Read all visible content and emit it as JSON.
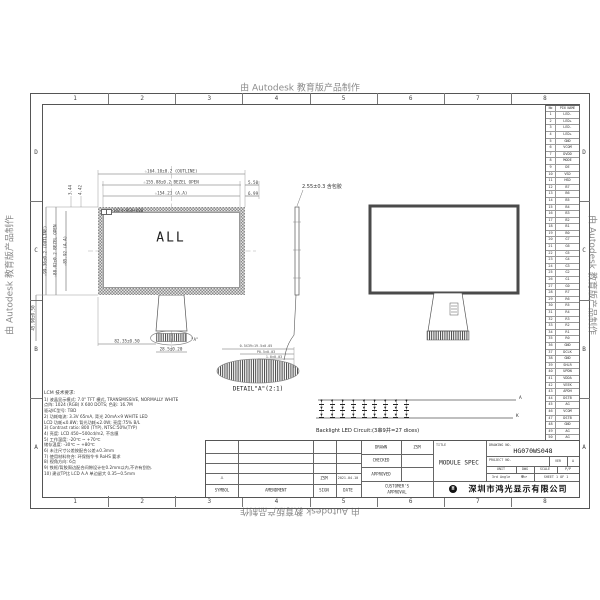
{
  "watermark": "由 Autodesk 教育版产品制作",
  "frame": {
    "columns": [
      "1",
      "2",
      "3",
      "4",
      "5",
      "6",
      "7",
      "8"
    ],
    "rows": [
      "D",
      "C",
      "B",
      "A"
    ]
  },
  "front_view": {
    "center_label": "ALL",
    "resolution_label": "1024×RGB×600",
    "dim_outline_w": "☆164.10±0.2 (OUTLINE)",
    "dim_bezel_w": "☆155.88±0.2 BEZEL OPEN",
    "dim_aa_w": "☆154.21 (A.A)",
    "dim_right_bezel": "5.50",
    "dim_right_aa": "6.99",
    "dim_outline_h": "☆99.36±0.2 (OUTLINE)",
    "dim_bezel_h": "☆88.02±0.2 BEZEL OPEN",
    "dim_aa_h": "☆85.92 (A.A)",
    "dim_fpc_drop": "45.90±0.50",
    "dim_offset_1": "3.44",
    "dim_offset_2": "4.42",
    "dim_fpc_x": "82.35±0.50",
    "dim_fpc_w": "28.5±0.20",
    "detail_ref": "\"A\""
  },
  "side_view": {
    "thickness": "2.55±0.3 含包胶"
  },
  "detail_a": {
    "label": "DETAIL\"A\"(2:1)",
    "dim1": "0.5X39=19.5±0.05",
    "dim2": "P0.5±0.03",
    "dim3": "1.0±0.03"
  },
  "led_circuit": {
    "caption": "Backlight LED Circuit:(3串9并=27 dices)",
    "anode_label": "A",
    "cathode_label": "K",
    "rows": 3,
    "cols": 9
  },
  "pin_table": {
    "header_no": "No",
    "header_name": "PIN NAME",
    "pins": [
      {
        "no": "1",
        "name": "LED-"
      },
      {
        "no": "2",
        "name": "LED+"
      },
      {
        "no": "3",
        "name": "LED-"
      },
      {
        "no": "4",
        "name": "LED+"
      },
      {
        "no": "5",
        "name": "GND"
      },
      {
        "no": "6",
        "name": "VCOM"
      },
      {
        "no": "7",
        "name": "DVDD"
      },
      {
        "no": "8",
        "name": "MODE"
      },
      {
        "no": "9",
        "name": "DE"
      },
      {
        "no": "10",
        "name": "VSD"
      },
      {
        "no": "11",
        "name": "HSD"
      },
      {
        "no": "12",
        "name": "B7"
      },
      {
        "no": "13",
        "name": "B6"
      },
      {
        "no": "14",
        "name": "B5"
      },
      {
        "no": "15",
        "name": "B4"
      },
      {
        "no": "16",
        "name": "B3"
      },
      {
        "no": "17",
        "name": "B2"
      },
      {
        "no": "18",
        "name": "B1"
      },
      {
        "no": "19",
        "name": "B0"
      },
      {
        "no": "20",
        "name": "G7"
      },
      {
        "no": "21",
        "name": "G6"
      },
      {
        "no": "22",
        "name": "G5"
      },
      {
        "no": "23",
        "name": "G4"
      },
      {
        "no": "24",
        "name": "G3"
      },
      {
        "no": "25",
        "name": "G2"
      },
      {
        "no": "26",
        "name": "G1"
      },
      {
        "no": "27",
        "name": "G0"
      },
      {
        "no": "28",
        "name": "R7"
      },
      {
        "no": "29",
        "name": "R6"
      },
      {
        "no": "30",
        "name": "R5"
      },
      {
        "no": "31",
        "name": "R4"
      },
      {
        "no": "32",
        "name": "R3"
      },
      {
        "no": "33",
        "name": "R2"
      },
      {
        "no": "34",
        "name": "R1"
      },
      {
        "no": "35",
        "name": "R0"
      },
      {
        "no": "36",
        "name": "GND"
      },
      {
        "no": "37",
        "name": "DCLK"
      },
      {
        "no": "38",
        "name": "GND"
      },
      {
        "no": "39",
        "name": "SHLR"
      },
      {
        "no": "40",
        "name": "UPDN"
      },
      {
        "no": "41",
        "name": "VDDA"
      },
      {
        "no": "42",
        "name": "VEEK"
      },
      {
        "no": "43",
        "name": "APDH"
      },
      {
        "no": "44",
        "name": "DSTB"
      },
      {
        "no": "45",
        "name": "AG"
      },
      {
        "no": "46",
        "name": "VCOM"
      },
      {
        "no": "47",
        "name": "DSTB"
      },
      {
        "no": "48",
        "name": "GND"
      },
      {
        "no": "49",
        "name": "AG"
      },
      {
        "no": "50",
        "name": "AG"
      }
    ]
  },
  "notes": {
    "title": "LCM 技术要求:",
    "lines": [
      "1) 液晶显示模式: 7.0\" TFT 横式, TRANSMISSIVE, NORMALLY WHITE",
      "   点阵: 1024 (RGB) X 600 DOTS; 色彩: 16.7M",
      "   驱动IC型号: TBD",
      "2) 功耗电流: 3.3V 65mA, 背光 20mA×9 WHITE LED",
      "   LCD 功耗≤0.8W; 背光功耗≤2.0W; 亮度:75% B/L",
      "3) Contrast ratio: 800 (TYP), NTSC:50%(TYP)",
      "4) 亮度: LCD 450~500cd/m2, 不含膜",
      "5) 工作温度: -20℃ ~ +70℃",
      "   储存温度: -30℃ ~ +80℃",
      "6) 未注尺寸公差按配合公差±0.3mm",
      "7) 使用材料符合: 环保指令书 RoHS 要求",
      "8) 视角方向: 6点",
      "9) 铁框/背胶周边配合间隙设计在0.2mm以内,不许有刮伤.",
      "10) 建议TP比 LCD A.A 单边留大 0.35~0.5mm"
    ]
  },
  "title_block": {
    "drawn_label": "DRAWN",
    "drawn_value": "ZSM",
    "checked_label": "CHECKED",
    "approved_label": "APPROVED",
    "customer_label_1": "CUSTOMER'S",
    "customer_label_2": "APPROVAL",
    "title_label": "TITLE",
    "title_value": "MODULE SPEC",
    "drawing_no_label": "DRAWING NO.",
    "drawing_no_value": "HG070WS048",
    "project_label": "PROJECT NO.",
    "ver_label": "VER",
    "ver_value": "A",
    "unit_label": "UNIT",
    "unit_value": "DWG",
    "scale_label": "SCALE",
    "scale_value": "P/P",
    "angle_label": "3rd Angle",
    "angle_symbol": "⊕▱",
    "sheet_label": "SHEET 1 OF 1",
    "company": "深圳市鸿光显示有限公司",
    "logo_glyph": "H",
    "symbol_label": "SYMBOL",
    "amendment_label": "AMENDMENT",
    "sign_label": "SIGN",
    "date_label": "DATE",
    "rev_symbol": "△",
    "rev_sign": "ZSM",
    "rev_date": "2021.04.10"
  },
  "colors": {
    "line": "#555555",
    "hatch": "#8a8a8a",
    "watermark": "#8a8a8a",
    "paper": "#ffffff"
  }
}
